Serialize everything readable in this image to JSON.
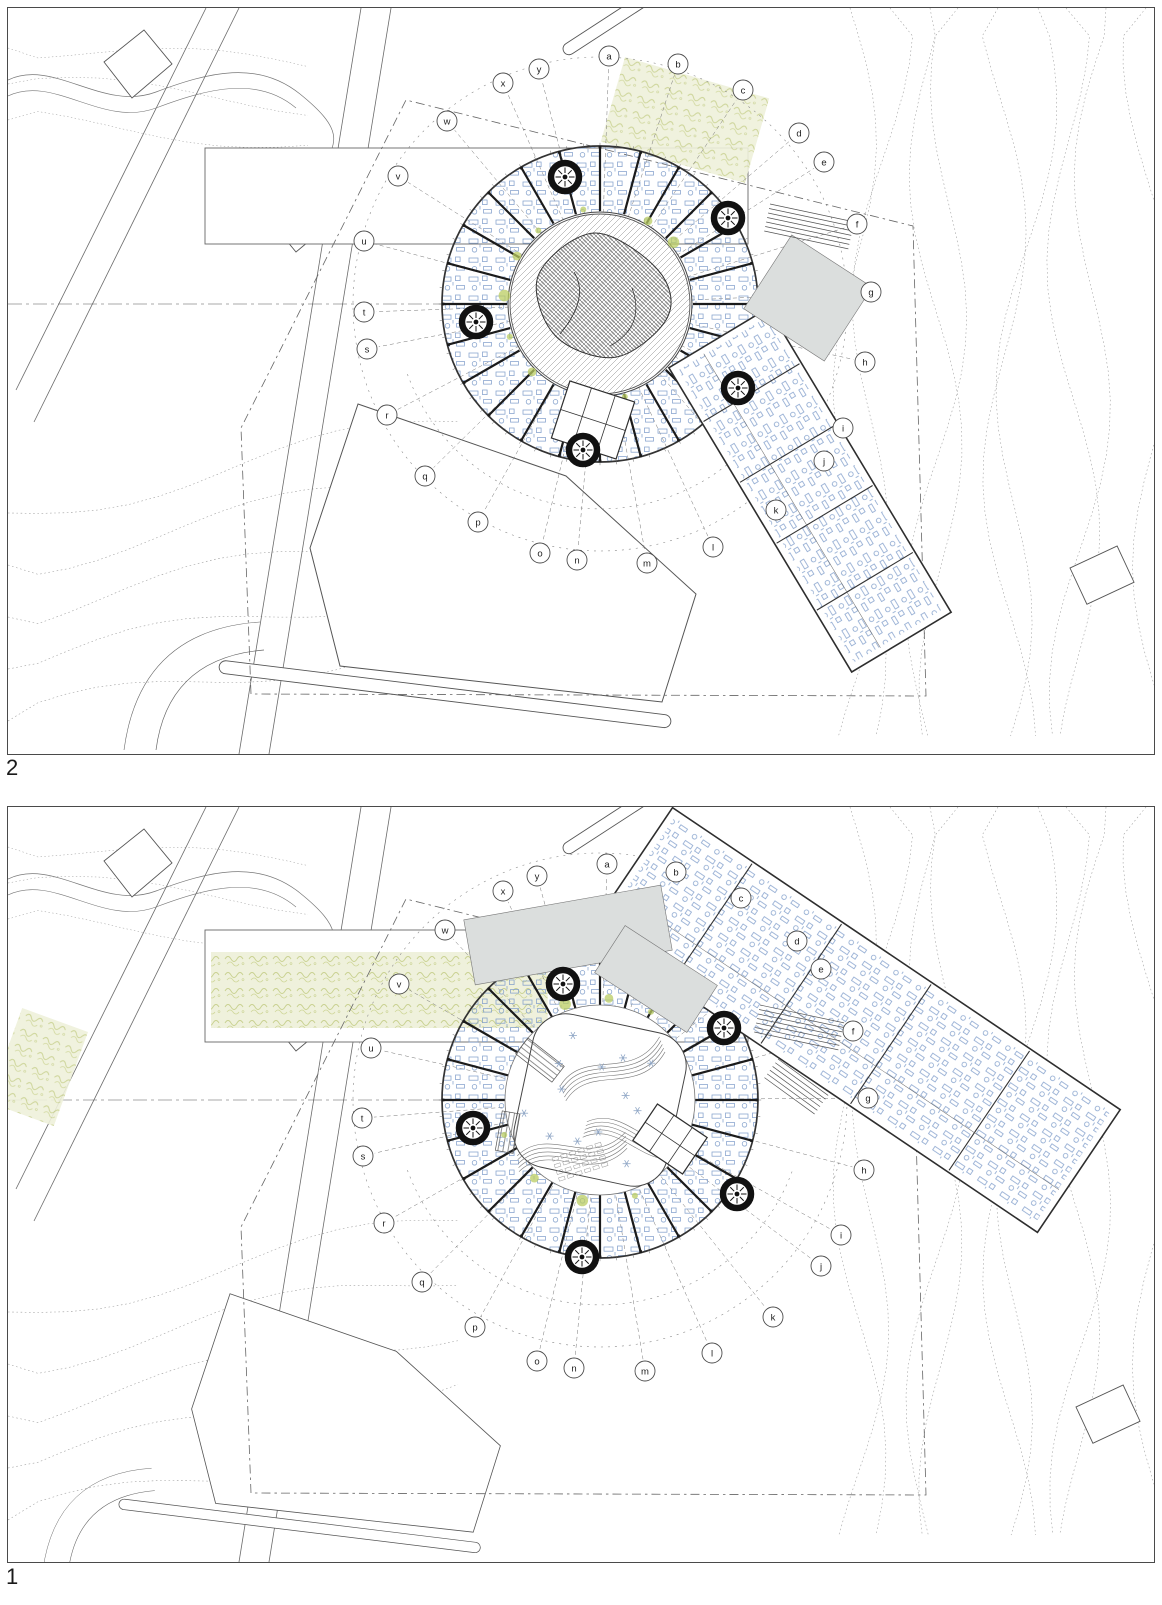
{
  "sheet": {
    "type": "architectural-site-plan-sheet",
    "description": "Two circular school building floor plans with radial grid markers over topographic site survey"
  },
  "colors": {
    "line": "#6b6b6b",
    "contour": "#9a9a9a",
    "wall": "#1b1b1b",
    "outline": "#333333",
    "furniture": "#7d9cc9",
    "flower": "#90a7c6",
    "green_fill": "#eef0da",
    "green_stroke": "#c6cf8a",
    "green_dot": "#b9cc62",
    "gray_area": "#dbdedd",
    "stair": "#111111",
    "dash": "#777777",
    "marker_stroke": "#4d4d4d",
    "label": "#1a1a1a"
  },
  "panels": [
    {
      "label": "2",
      "name": "floor-plan-level-2",
      "frame": {
        "w": 1146,
        "h": 746
      },
      "ring": {
        "cx": 592,
        "cy": 296,
        "outer": 158,
        "inner": 92,
        "marker_circle": 247,
        "wall_step_deg": 15,
        "courtyard_r": 90
      },
      "courtyard": {
        "type": "hatched-landscape"
      },
      "markers": [
        {
          "l": "a",
          "x": 601,
          "y": 48
        },
        {
          "l": "b",
          "x": 670,
          "y": 56
        },
        {
          "l": "c",
          "x": 735,
          "y": 82
        },
        {
          "l": "d",
          "x": 791,
          "y": 125
        },
        {
          "l": "e",
          "x": 816,
          "y": 154
        },
        {
          "l": "f",
          "x": 849,
          "y": 216
        },
        {
          "l": "g",
          "x": 863,
          "y": 284
        },
        {
          "l": "h",
          "x": 857,
          "y": 354
        },
        {
          "l": "i",
          "x": 835,
          "y": 420
        },
        {
          "l": "j",
          "x": 816,
          "y": 453
        },
        {
          "l": "k",
          "x": 768,
          "y": 502
        },
        {
          "l": "l",
          "x": 705,
          "y": 539
        },
        {
          "l": "m",
          "x": 639,
          "y": 555
        },
        {
          "l": "n",
          "x": 569,
          "y": 552
        },
        {
          "l": "o",
          "x": 532,
          "y": 545
        },
        {
          "l": "p",
          "x": 470,
          "y": 514
        },
        {
          "l": "q",
          "x": 417,
          "y": 468
        },
        {
          "l": "r",
          "x": 379,
          "y": 407
        },
        {
          "l": "s",
          "x": 359,
          "y": 341
        },
        {
          "l": "t",
          "x": 356,
          "y": 304
        },
        {
          "l": "u",
          "x": 356,
          "y": 233
        },
        {
          "l": "v",
          "x": 390,
          "y": 168
        },
        {
          "l": "w",
          "x": 439,
          "y": 113
        },
        {
          "l": "x",
          "x": 495,
          "y": 75
        },
        {
          "l": "y",
          "x": 531,
          "y": 61
        }
      ],
      "stairs": [
        [
          557,
          169
        ],
        [
          720,
          210
        ],
        [
          468,
          314
        ],
        [
          730,
          380
        ],
        [
          575,
          442
        ]
      ],
      "wing": {
        "cx": 802,
        "cy": 482,
        "len": 355,
        "wid": 116,
        "angle": 59
      },
      "gray_areas": [
        {
          "cx": 800,
          "cy": 290,
          "w": 96,
          "h": 88,
          "angle": 33
        }
      ],
      "steps": [
        {
          "x": 762,
          "y": 196,
          "angle": 12,
          "len": 86,
          "n": 7,
          "gap": 4.6
        }
      ],
      "band_rect": {
        "x": 197,
        "y": 140,
        "w": 543,
        "h": 96,
        "green": false
      },
      "green_patches": [
        {
          "cx": 677,
          "cy": 112,
          "w": 150,
          "h": 88,
          "angle": 16
        }
      ],
      "small_rooms": {
        "x": 585,
        "y": 412,
        "angle": 18,
        "w": 68,
        "h": 60
      },
      "sw": {
        "dx": 0,
        "dy": 0,
        "s": 1
      },
      "ne": {
        "x": 1062,
        "y": 560,
        "angle": -25
      }
    },
    {
      "label": "1",
      "name": "floor-plan-level-1",
      "frame": {
        "w": 1146,
        "h": 755
      },
      "ring": {
        "cx": 592,
        "cy": 293,
        "outer": 158,
        "inner": 92,
        "marker_circle": 247,
        "wall_step_deg": 15,
        "courtyard_r": 95
      },
      "courtyard": {
        "type": "terraced-atrium"
      },
      "markers": [
        {
          "l": "a",
          "x": 599,
          "y": 57
        },
        {
          "l": "b",
          "x": 668,
          "y": 65
        },
        {
          "l": "c",
          "x": 733,
          "y": 91
        },
        {
          "l": "d",
          "x": 789,
          "y": 134
        },
        {
          "l": "e",
          "x": 813,
          "y": 162
        },
        {
          "l": "f",
          "x": 845,
          "y": 224
        },
        {
          "l": "g",
          "x": 860,
          "y": 291
        },
        {
          "l": "h",
          "x": 856,
          "y": 363
        },
        {
          "l": "i",
          "x": 833,
          "y": 428
        },
        {
          "l": "j",
          "x": 813,
          "y": 459
        },
        {
          "l": "k",
          "x": 765,
          "y": 510
        },
        {
          "l": "l",
          "x": 704,
          "y": 546
        },
        {
          "l": "m",
          "x": 637,
          "y": 564
        },
        {
          "l": "n",
          "x": 566,
          "y": 561
        },
        {
          "l": "o",
          "x": 529,
          "y": 554
        },
        {
          "l": "p",
          "x": 467,
          "y": 520
        },
        {
          "l": "q",
          "x": 414,
          "y": 475
        },
        {
          "l": "r",
          "x": 376,
          "y": 416
        },
        {
          "l": "s",
          "x": 355,
          "y": 349
        },
        {
          "l": "t",
          "x": 354,
          "y": 311
        },
        {
          "l": "u",
          "x": 363,
          "y": 241
        },
        {
          "l": "v",
          "x": 391,
          "y": 177
        },
        {
          "l": "w",
          "x": 437,
          "y": 123
        },
        {
          "l": "x",
          "x": 495,
          "y": 84
        },
        {
          "l": "y",
          "x": 529,
          "y": 69
        }
      ],
      "stairs": [
        [
          555,
          177
        ],
        [
          716,
          221
        ],
        [
          465,
          321
        ],
        [
          729,
          387
        ],
        [
          574,
          450
        ]
      ],
      "wing": {
        "cx": 847,
        "cy": 213,
        "len": 540,
        "wid": 148,
        "angle": 34
      },
      "gray_areas": [
        {
          "cx": 560,
          "cy": 128,
          "w": 200,
          "h": 66,
          "angle": -10
        },
        {
          "cx": 648,
          "cy": 172,
          "w": 110,
          "h": 56,
          "angle": 33
        }
      ],
      "steps": [
        {
          "x": 752,
          "y": 198,
          "angle": 12,
          "len": 86,
          "n": 7,
          "gap": 4.6
        },
        {
          "x": 770,
          "y": 252,
          "angle": 36,
          "len": 62,
          "n": 6,
          "gap": 4.6
        }
      ],
      "band_rect": {
        "x": 197,
        "y": 123,
        "w": 543,
        "h": 112,
        "green": true
      },
      "green_patches": [
        {
          "cx": 30,
          "cy": 260,
          "w": 70,
          "h": 100,
          "angle": 20
        }
      ],
      "small_rooms": {
        "x": 662,
        "y": 332,
        "angle": 34,
        "w": 60,
        "h": 44
      },
      "sw": {
        "dx": -58,
        "dy": 170,
        "s": 0.8
      },
      "ne": {
        "x": 1068,
        "y": 600,
        "angle": -25
      }
    }
  ]
}
